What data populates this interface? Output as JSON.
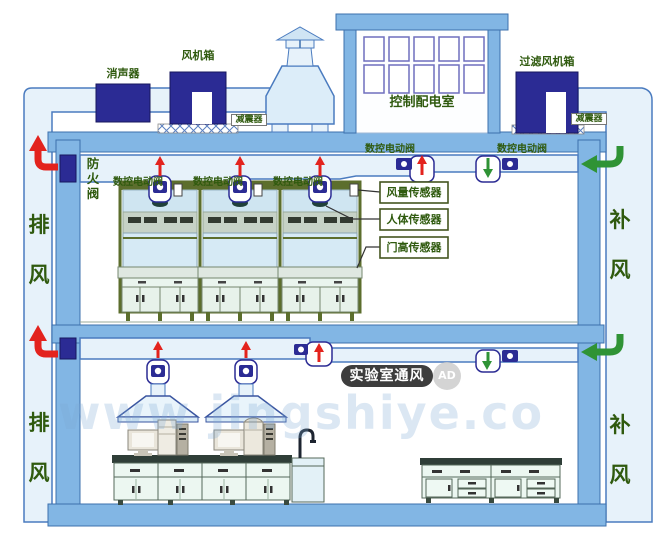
{
  "rooftop": {
    "silencer_label": "消声器",
    "fan_box_label": "风机箱",
    "shock_absorber_left_label": "减震器",
    "shock_absorber_right_label": "减震器",
    "control_room_label": "控制配电室",
    "filter_fan_box_label": "过滤风机箱"
  },
  "left_shaft": {
    "upper_label": "排\n风",
    "lower_label": "排\n风"
  },
  "right_shaft": {
    "upper_label": "补\n风",
    "lower_label": "补\n风"
  },
  "upper_floor": {
    "fire_damper_label": "防\n火\n阀",
    "valve_labels": [
      "数控电动阀",
      "数控电动阀",
      "数控电动阀",
      "数控电动阀",
      "数控电动阀"
    ],
    "sensor_callouts": [
      "风量传感器",
      "人体传感器",
      "门高传感器"
    ]
  },
  "watermark": {
    "badge": "实验室通风",
    "ad": "AD",
    "site_text": "www      jingshiye.co"
  },
  "colors": {
    "structure_blue": "#82b6e4",
    "duct_fill": "#e7f2fa",
    "equipment_navy": "#2b2b94",
    "exhaust_red": "#e3231d",
    "supply_green": "#2f9335",
    "label_green": "#2f5a0e",
    "hood_olive": "#5c6e2d"
  }
}
